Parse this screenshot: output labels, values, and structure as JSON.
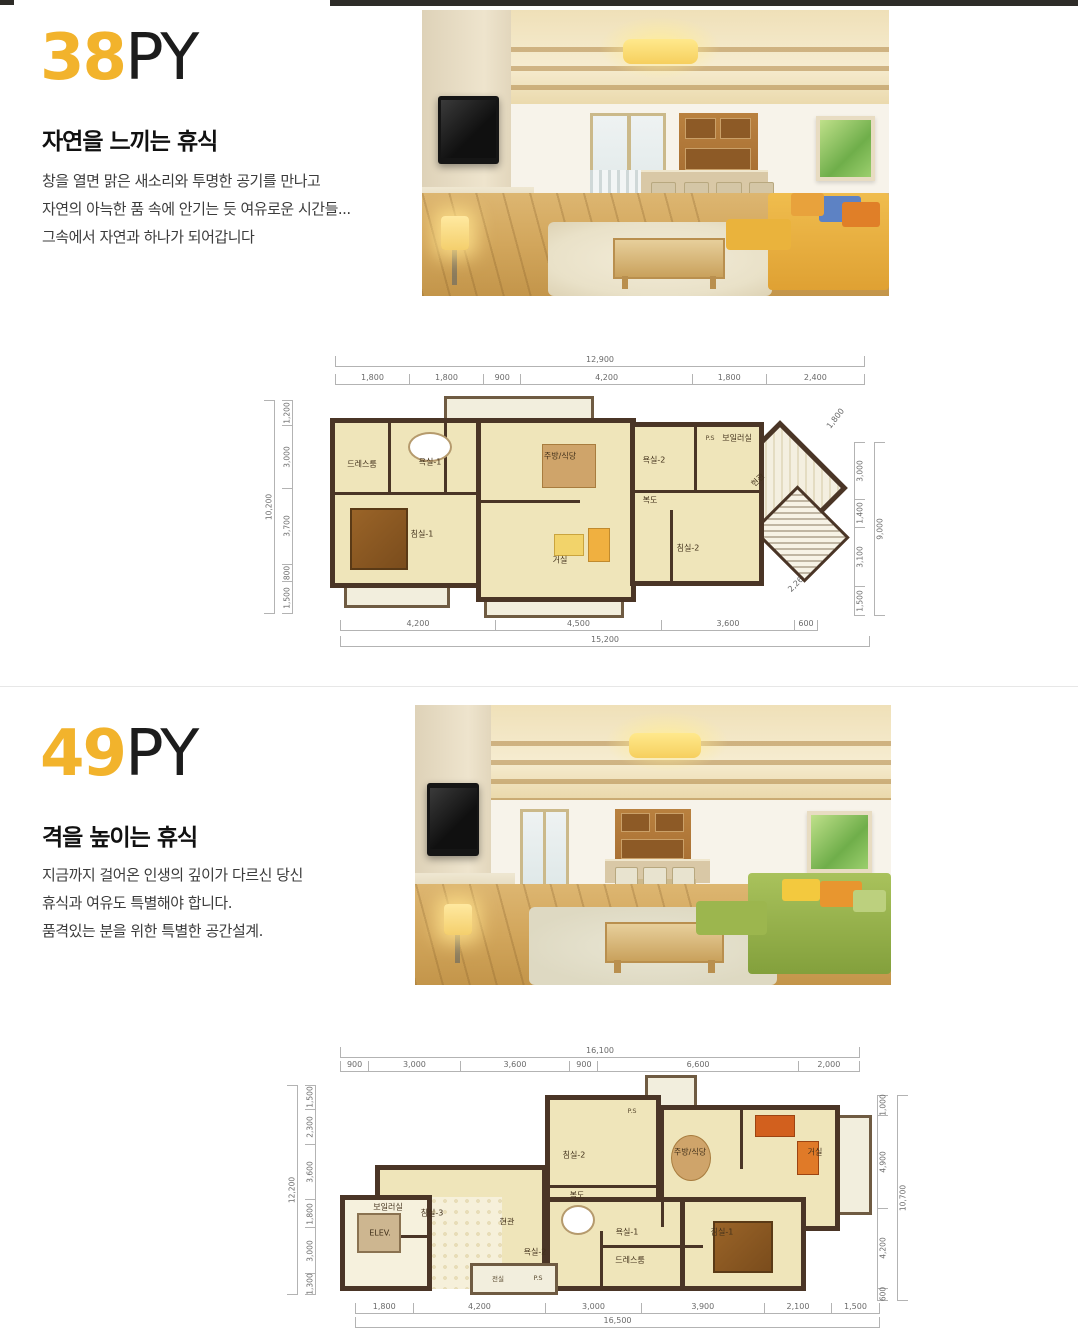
{
  "accent_color": "#f2b32c",
  "sections": [
    {
      "size_number": "38",
      "size_suffix": "PY",
      "heading": "자연을 느끼는 휴식",
      "body_lines": [
        "창을 열면 맑은 새소리와 투명한 공기를 만나고",
        "자연의 아늑한 품 속에 안기는 듯 여유로운 시간들...",
        "그속에서 자연과 하나가 되어갑니다"
      ],
      "floorplan": {
        "top": {
          "total": "12,900",
          "segments": [
            "1,800",
            "1,800",
            "900",
            "4,200",
            "1,800",
            "2,400"
          ]
        },
        "bottom": {
          "total": "15,200",
          "segments": [
            "4,200",
            "4,500",
            "3,600",
            "600"
          ]
        },
        "left": {
          "total": "10,200",
          "segments": [
            "1,200",
            "3,000",
            "3,700",
            "800",
            "1,500"
          ]
        },
        "right": {
          "total": "9,000",
          "segments": [
            "3,000",
            "1,400",
            "3,100",
            "1,500"
          ]
        },
        "diagonal_top_right": "1,800",
        "diagonal_bottom_right": "2,264",
        "rooms": {
          "dress": "드레스룸",
          "bath1": "욕실-1",
          "kitchen": "주방/식당",
          "bath2": "욕실-2",
          "boiler": "보일러실",
          "ps": "P.S",
          "entrance": "현관",
          "hall": "복도",
          "bed1": "침실-1",
          "living": "거실",
          "bed2": "침실-2"
        }
      }
    },
    {
      "size_number": "49",
      "size_suffix": "PY",
      "heading": "격을 높이는 휴식",
      "body_lines": [
        "지금까지 걸어온 인생의 깊이가 다르신 당신",
        "휴식과 여유도 특별해야 합니다.",
        "품격있는 분을 위한 특별한 공간설계."
      ],
      "floorplan": {
        "top": {
          "total": "16,100",
          "segments": [
            "900",
            "3,000",
            "3,600",
            "900",
            "6,600",
            "2,000"
          ]
        },
        "bottom": {
          "total": "16,500",
          "segments": [
            "1,800",
            "4,200",
            "3,000",
            "3,900",
            "2,100",
            "1,500"
          ]
        },
        "left": {
          "total": "12,200",
          "segments": [
            "1,500",
            "2,300",
            "3,600",
            "1,800",
            "3,000",
            "1,300"
          ]
        },
        "right": {
          "total": "10,700",
          "segments": [
            "1,000",
            "4,900",
            "4,200",
            "600"
          ]
        },
        "rooms": {
          "bed3": "침실-3",
          "bed2": "침실-2",
          "ps1": "P.S",
          "kitchen": "주방/식당",
          "living": "거실",
          "hall": "복도",
          "boiler": "보일러실",
          "elev": "ELEV.",
          "entrance": "현관",
          "bath2": "욕실-2",
          "bath1": "욕실-1",
          "dress": "드레스룸",
          "bed1": "침실-1",
          "vestibule": "전실",
          "ps2": "P.S"
        }
      }
    }
  ]
}
